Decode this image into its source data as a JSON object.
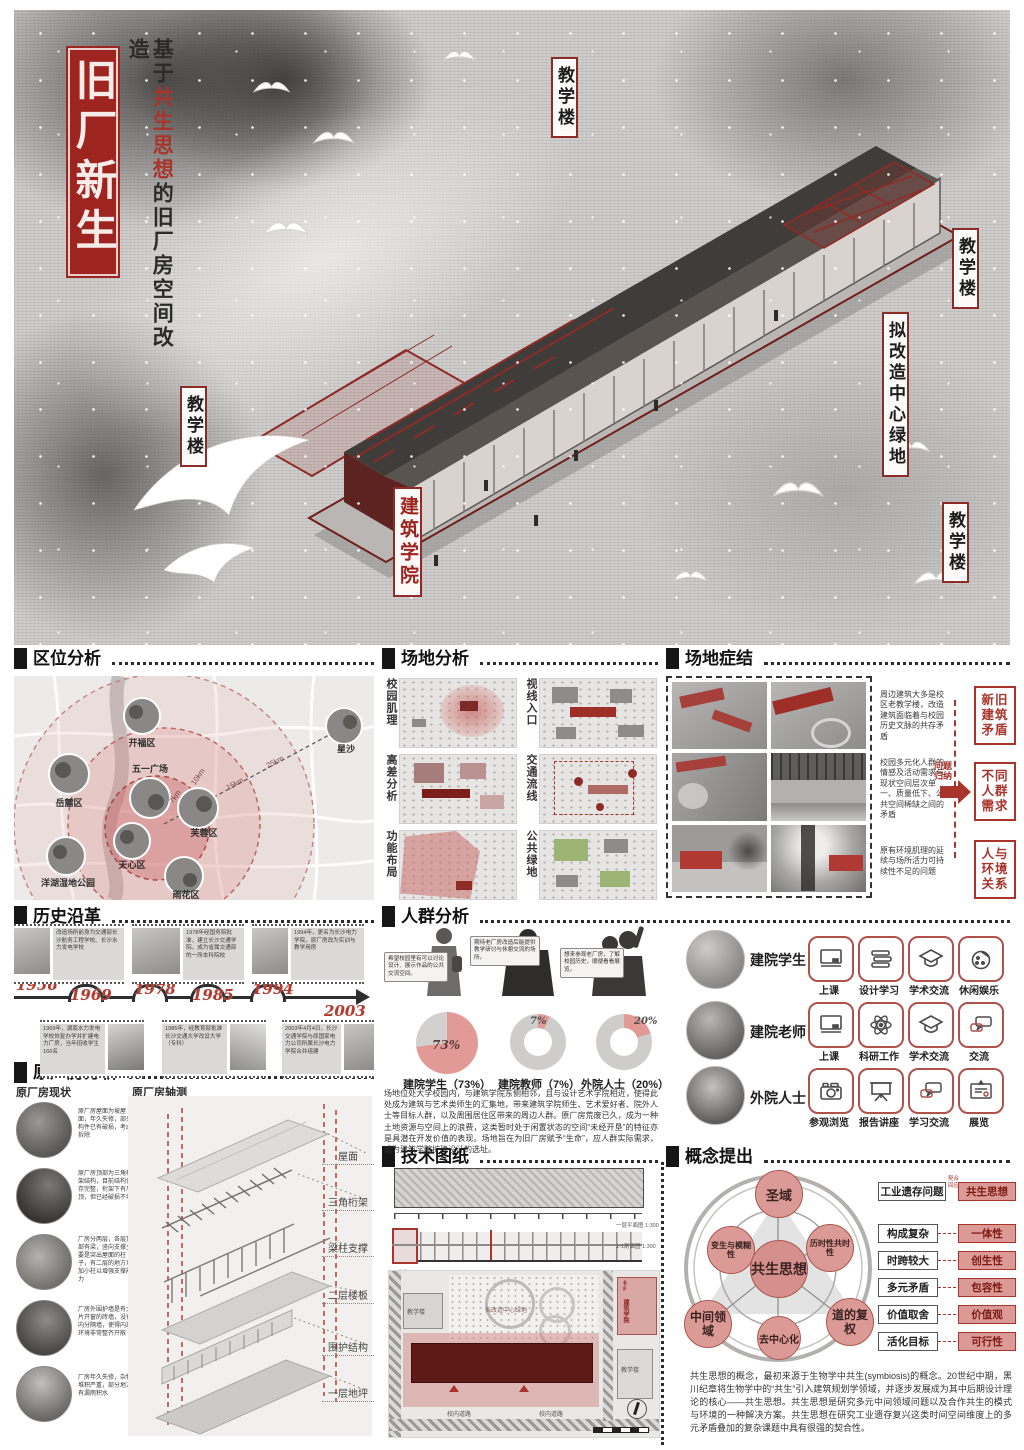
{
  "title": {
    "box": "旧厂新生",
    "sub_pre": "基于",
    "sub_red": "共生思想",
    "sub_post": "的旧厂房空间改造"
  },
  "hero": {
    "l1": "教学楼",
    "l2": "教学楼",
    "l3": "拟改造中心绿地",
    "l4": "教学楼",
    "l5": "教学楼",
    "college": "建筑学院"
  },
  "colors": {
    "accent": "#a8342c",
    "pink": "#dc9a97",
    "dark_red": "#5d1a17"
  },
  "loc": {
    "header": "区位分析",
    "places": [
      "开福区",
      "五一广场",
      "岳麓区",
      "芙蓉区",
      "天心区",
      "洋湖湿地公园",
      "雨花区",
      "星沙"
    ],
    "dist": [
      "7km",
      "10km",
      "15km",
      "25km"
    ]
  },
  "site": {
    "header": "场地分析",
    "maps": [
      "校园肌理",
      "视线入口",
      "高差分析",
      "交通流线",
      "功能布局",
      "公共绿地"
    ]
  },
  "prob": {
    "header": "场地症结",
    "notes": [
      "周边建筑大多是校区老教学楼，改造建筑面临着与校园历史文脉的共存矛盾",
      "校园多元化人群的情感及活动需求与现状空间层次单一、质量低下、公共空间稀缺之间的矛盾",
      "原有环境肌理的延续与场所活力可持续性不足的问题"
    ],
    "arrow": "问题归纳",
    "results": [
      "新旧建筑矛盾",
      "不同人群需求",
      "人与环境关系"
    ]
  },
  "hist": {
    "header": "历史沿革",
    "events": [
      {
        "year": "1956",
        "text": "改造场所前身为交通部长沙航务工程学校、长沙水力发电学校"
      },
      {
        "year": "1969",
        "text": "1969年，湖南水力发电学校恢复办学并扩建电力厂房，当年招收学生160名"
      },
      {
        "year": "1978",
        "text": "1978年经国务院批准，建立长沙交通学院，成为省属交通部的一所本科院校"
      },
      {
        "year": "1985",
        "text": "1985年，经教育部批准长沙交通大学改设大学（专科）"
      },
      {
        "year": "1994",
        "text": "1994年，更名为长沙电力学院，原厂房改为实训与教学用房"
      },
      {
        "year": "2003",
        "text": "2003年4月4日，长沙交通学院与原国家电力公司所属长沙电力学院合并组建"
      }
    ]
  },
  "crowd": {
    "header": "人群分析",
    "bubbles": [
      "希望校园里有可以讨论设计、展示作品的公共交流空间。",
      "期待老厂房改造后能提供教学研讨与休憩交流的场所。",
      "想来参观老厂房，了解校园历史，顺便看看展览。"
    ],
    "pies": [
      {
        "label": "建院学生（73%）",
        "pct": "73%"
      },
      {
        "label": "建院教师（7%）",
        "pct": "7%"
      },
      {
        "label": "外院人士（20%）",
        "pct": "20%"
      }
    ],
    "groups": [
      {
        "name": "建院学生",
        "a": [
          "上课",
          "设计学习",
          "学术交流",
          "休闲娱乐"
        ]
      },
      {
        "name": "建院老师",
        "a": [
          "上课",
          "科研工作",
          "学术交流",
          "交流"
        ]
      },
      {
        "name": "外院人士",
        "a": [
          "参观浏览",
          "报告讲座",
          "学习交流",
          "展览"
        ]
      }
    ],
    "para": "场地位处大学校园内，与建筑学院东侧相邻，且与设计艺术学院相近，使得此处成为建筑与艺术类师生的汇集地，带来建筑学院师生、艺术爱好者、院外人士等目标人群，以及周围居住区带来的周边人群。原厂房荒废已久，成为一种土地资源与空间上的浪费，这类暂时处于闲置状态的空间“未经开垦”的特征亦是具潜在开发价值的表现。场地旨在为旧厂房赋予“生命”，应人群实际需求，成为建筑学院扩建设计的选址。"
  },
  "fact": {
    "header": "原厂房分析",
    "left": "原厂房现状",
    "right": "原厂房轴测",
    "notes": [
      "原厂房屋面为坡屋面，年久失修，部分构件已有破损，考虑拆除",
      "原厂房顶部为三角桁架结构，目前结构保存完整，桁架下有吊顶，但已经破损不堪",
      "厂房分两层，各层顶部有梁，竖向支撑主要是突出屋面的柱子，有二层的地方增加小柱以增强支撑能力",
      "厂房外围护墙是有大片开窗的砖墙，没有内分隔墙，使得内部环境非常整齐开敞",
      "厂房年久失修，杂物堆积严重，部分地方有漏雨积水"
    ],
    "axon": [
      "屋面",
      "三角桁架",
      "梁柱支撑",
      "二层楼板",
      "围护结构",
      "一层地坪"
    ]
  },
  "tech": {
    "header": "技术图纸",
    "cap1": "一层平面图 1:300",
    "cap2": "1-1剖面图 1:300",
    "plan": "总平面图",
    "green": "拟改造中心绿地",
    "college": "6F 建筑学院",
    "t1": "教学楼",
    "t2": "教学楼",
    "road1": "校内道路",
    "road2": "校内道路"
  },
  "con": {
    "header": "概念提出",
    "center": "共生思想",
    "nodes": [
      "圣域",
      "变生与模糊性",
      "历时性共时性",
      "中间领域",
      "去中心化",
      "道的复权"
    ],
    "from": "工业遗存问题",
    "via1": "契合",
    "via2": "回应",
    "to": "共生思想",
    "pairs": [
      [
        "构成复杂",
        "一体性"
      ],
      [
        "时跨较大",
        "创生性"
      ],
      [
        "多元矛盾",
        "包容性"
      ],
      [
        "价值取舍",
        "价值观"
      ],
      [
        "活化目标",
        "可行性"
      ]
    ],
    "para": "共生思想的概念，最初来源于生物学中共生(symbiosis)的概念。20世纪中期，黑川纪章将生物学中的“共生”引入建筑规划学领域，并逐步发展成为其中后期设计理论的核心——共生思想。共生思想是研究多元中间领域问题以及合作共生的模式与环境的一种解决方案。共生思想在研究工业遗存复兴这类时间空间维度上的多元矛盾叠加的复杂课题中具有很强的契合性。"
  },
  "chart_data": {
    "type": "pie",
    "title": "人群构成",
    "slices": [
      {
        "label": "建院学生",
        "value": 73
      },
      {
        "label": "建院教师",
        "value": 7
      },
      {
        "label": "外院人士",
        "value": 20
      }
    ],
    "legend_position": "below"
  }
}
